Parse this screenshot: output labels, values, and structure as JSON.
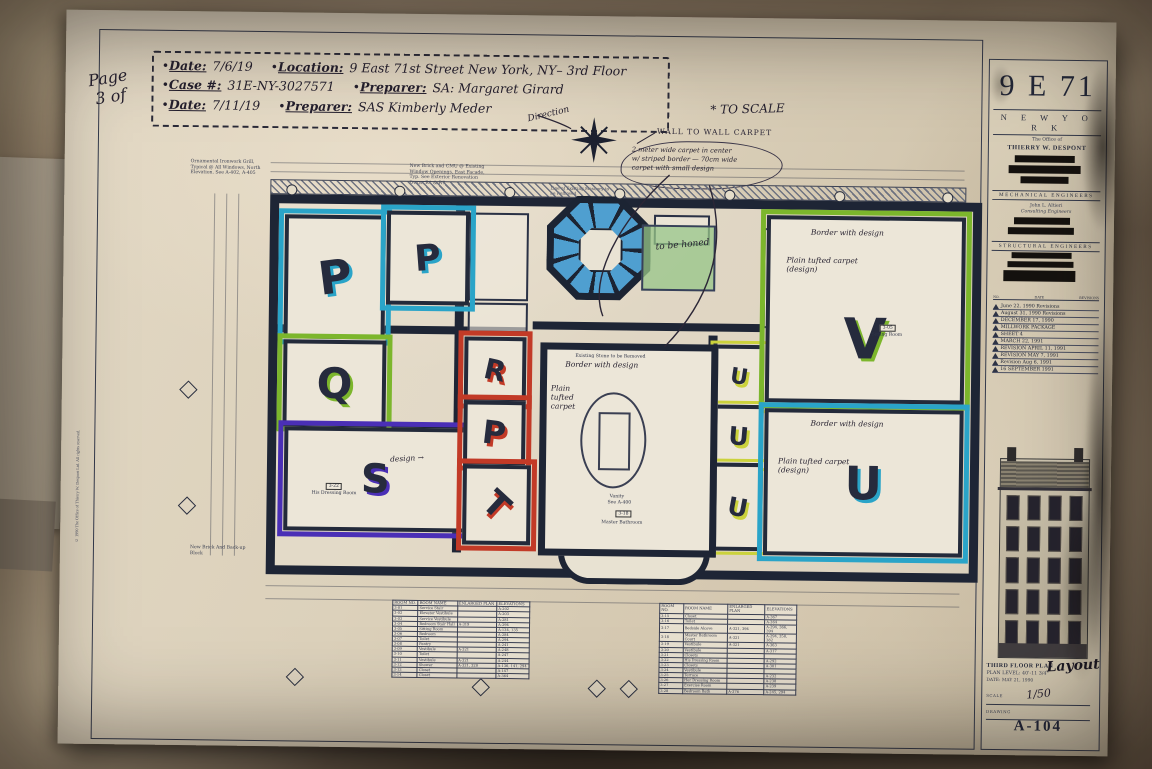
{
  "page_label": {
    "line1": "Page",
    "line2": "3 of"
  },
  "header": {
    "bullet": "•",
    "row1": {
      "date_label": "Date:",
      "date": "7/6/19",
      "location_label": "Location:",
      "location": "9 East 71st Street New York, NY– 3rd Floor"
    },
    "row2": {
      "case_label": "Case #:",
      "case_number": "31E-NY-3027571",
      "preparer_label": "Preparer:",
      "preparer": "SA: Margaret Girard"
    },
    "row3": {
      "date_label": "Date:",
      "date": "7/11/19",
      "preparer_label": "Preparer:",
      "preparer": "SAS Kimberly Meder"
    }
  },
  "annotations": {
    "to_scale": "* TO SCALE",
    "direction": "Direction",
    "wall_to_wall": "WALL TO WALL CARPET",
    "cloud_note_1": "2 meter wide carpet in center",
    "cloud_note_2": "w/ striped border — 70cm wide",
    "cloud_note_3": "carpet with small design",
    "to_be_honed": "to be honed",
    "design_note": "design →",
    "similar_note": "↳ similar modernization"
  },
  "printed_notes": {
    "ornamental": "Ornamental Ironwork Grill, Typical @ All Windows, North Elevation. See A-402, A-405",
    "new_brick": "New Brick and CMU @ Existing Window Openings, East Facade, Typ. See Exterior Renovation Dwgs. R1 & R7",
    "masonry": "Line of Existing Masonry to be Removed",
    "backup_block": "New Brick And Back-up Block",
    "copyright": "© 1990 The Office of Thierry W. Despont Ltd. All rights reserved."
  },
  "plan": {
    "marker_colors": {
      "cyan": "#2aa4c8",
      "green": "#7cb62c",
      "purple": "#4a2fb6",
      "red": "#c23a27",
      "yellow": "#cbd23c",
      "stair_blue": "#4f9fd0",
      "honed_green": "#97c588"
    },
    "rooms": [
      {
        "letter": "P",
        "color": "#2aa4c8"
      },
      {
        "letter": "P",
        "color": "#2aa4c8"
      },
      {
        "letter": "Q",
        "color": "#7cb62c"
      },
      {
        "letter": "S",
        "color": "#4a2fb6"
      },
      {
        "letter": "R",
        "color": "#c23a27"
      },
      {
        "letter": "P",
        "color": "#c23a27"
      },
      {
        "letter": "T",
        "color": "#c23a27"
      },
      {
        "letter": "U",
        "color": "#cbd23c"
      },
      {
        "letter": "U",
        "color": "#cbd23c"
      },
      {
        "letter": "U",
        "color": "#cbd23c"
      },
      {
        "letter": "V",
        "color": "#7cb62c"
      },
      {
        "letter": "U",
        "color": "#2aa4c8"
      }
    ],
    "room_s": {
      "number": "3-22",
      "label": "His Dressing Room"
    },
    "room_v": {
      "number": "3-05",
      "label": "Sitting Room",
      "note1": "Border with design",
      "note2": "Plain tufted carpet (design)"
    },
    "room_u4": {
      "note1": "Border with design",
      "note2": "Plain tufted carpet (design)"
    },
    "master_bath": {
      "number": "3-18",
      "label": "Master Bathroom",
      "vanity": "Vanity",
      "vanity_ref": "See A-400",
      "note1": "Border with design",
      "note2": "Plain tufted carpet",
      "stone_note": "Existing Stone to be Removed"
    }
  },
  "schedule_left": {
    "headers": {
      "no": "ROOM NO.",
      "name": "ROOM NAME",
      "plan": "ENLARGED PLAN",
      "elev": "ELEVATIONS"
    },
    "rows": [
      {
        "no": "3-01",
        "name": "Service Stair",
        "plan": "",
        "elev": "A-202"
      },
      {
        "no": "3-02",
        "name": "Elevator Vestibule",
        "plan": "",
        "elev": "A-203"
      },
      {
        "no": "3-03",
        "name": "Service Vestibule",
        "plan": "",
        "elev": "A-281"
      },
      {
        "no": "3-04",
        "name": "Bedroom Stair Hall",
        "plan": "A-319",
        "elev": "A-294"
      },
      {
        "no": "3-05",
        "name": "Sitting Room",
        "plan": "",
        "elev": "A-134, 135"
      },
      {
        "no": "3-06",
        "name": "Bedroom",
        "plan": "",
        "elev": "A-284"
      },
      {
        "no": "3-07",
        "name": "Toilet",
        "plan": "",
        "elev": "A-294"
      },
      {
        "no": "3-08",
        "name": "Pantry",
        "plan": "",
        "elev": "A-241"
      },
      {
        "no": "3-09",
        "name": "Vestibule",
        "plan": "A-321",
        "elev": "A-248"
      },
      {
        "no": "3-10",
        "name": "Toilet",
        "plan": "",
        "elev": "A-247"
      },
      {
        "no": "3-11",
        "name": "Vestibule",
        "plan": "A-321",
        "elev": "A-244"
      },
      {
        "no": "3-12",
        "name": "Shower",
        "plan": "A-321, 320",
        "elev": "A-136, 141, 294"
      },
      {
        "no": "3-13",
        "name": "Closet",
        "plan": "",
        "elev": "A-147"
      },
      {
        "no": "3-14",
        "name": "Closet",
        "plan": "",
        "elev": "A-364"
      }
    ]
  },
  "schedule_right": {
    "headers": {
      "no": "ROOM NO.",
      "name": "ROOM NAME",
      "plan": "ENLARGED PLAN",
      "elev": "ELEVATIONS"
    },
    "rows": [
      {
        "no": "3-15",
        "name": "Closet",
        "plan": "",
        "elev": "A-367"
      },
      {
        "no": "3-16",
        "name": "Toilet",
        "plan": "",
        "elev": "A-364"
      },
      {
        "no": "3-17",
        "name": "Bedside Alcove",
        "plan": "A-321, 394",
        "elev": "A-294, 366, 394"
      },
      {
        "no": "3-18",
        "name": "Master Bathroom Court",
        "plan": "A-321",
        "elev": "A-294, 358, 382"
      },
      {
        "no": "3-19",
        "name": "Vestibule",
        "plan": "A-321",
        "elev": "A-363"
      },
      {
        "no": "3-20",
        "name": "Vestibule",
        "plan": "",
        "elev": "A-317"
      },
      {
        "no": "3-21",
        "name": "Closets",
        "plan": "",
        "elev": ""
      },
      {
        "no": "3-22",
        "name": "His Dressing Room",
        "plan": "",
        "elev": "A-292"
      },
      {
        "no": "3-23",
        "name": "Closets",
        "plan": "",
        "elev": "A-301"
      },
      {
        "no": "3-24",
        "name": "Vestibule",
        "plan": "",
        "elev": ""
      },
      {
        "no": "3-25",
        "name": "Terrace",
        "plan": "",
        "elev": "A-232"
      },
      {
        "no": "3-26",
        "name": "Her Dressing Room",
        "plan": "",
        "elev": "A-238"
      },
      {
        "no": "3-27",
        "name": "Exercise Room",
        "plan": "",
        "elev": "A-239"
      },
      {
        "no": "3-28",
        "name": "Bedroom Bath",
        "plan": "A-376",
        "elev": "A-245, 294"
      }
    ]
  },
  "titleblock": {
    "project": "9 E 71",
    "city": "N E W   Y O R K",
    "office_line": "The Office of",
    "architect": "THIERRY W. DESPONT",
    "mech_heading": "MECHANICAL ENGINEERS",
    "mech_name": "John L. Altieri",
    "mech_role": "Consulting Engineers",
    "struct_heading": "STRUCTURAL ENGINEERS",
    "rev_head_no": "NO.",
    "rev_head_date": "DATE",
    "rev_head_rev": "REVISIONS",
    "revisions": [
      {
        "num": "1",
        "text": "June 22, 1990 Revisions"
      },
      {
        "num": "2",
        "text": "August 31, 1990 Revisions"
      },
      {
        "num": "3",
        "text": "DECEMBER 17, 1990"
      },
      {
        "num": "",
        "text": "MILLWORK PACKAGE"
      },
      {
        "num": "",
        "text": "SHEET 4"
      },
      {
        "num": "4",
        "text": "MARCH 22, 1991"
      },
      {
        "num": "5",
        "text": "REVISION APRIL 11, 1991"
      },
      {
        "num": "6",
        "text": "REVISION MAY 7, 1991"
      },
      {
        "num": "7",
        "text": "Revision Aug 6, 1991"
      },
      {
        "num": "8",
        "text": "16 SEPTEMBER 1991"
      }
    ],
    "title_line1": "THIRD FLOOR PLAN",
    "title_line2": "PLAN LEVEL: 40'-11 3/4\"",
    "title_line3": "DATE: MAY 21, 1990",
    "layout_hand": "Layout",
    "scale_label": "SCALE",
    "scale_hand": "1/50",
    "drawing_label": "DRAWING",
    "sheet_number": "A-104"
  }
}
